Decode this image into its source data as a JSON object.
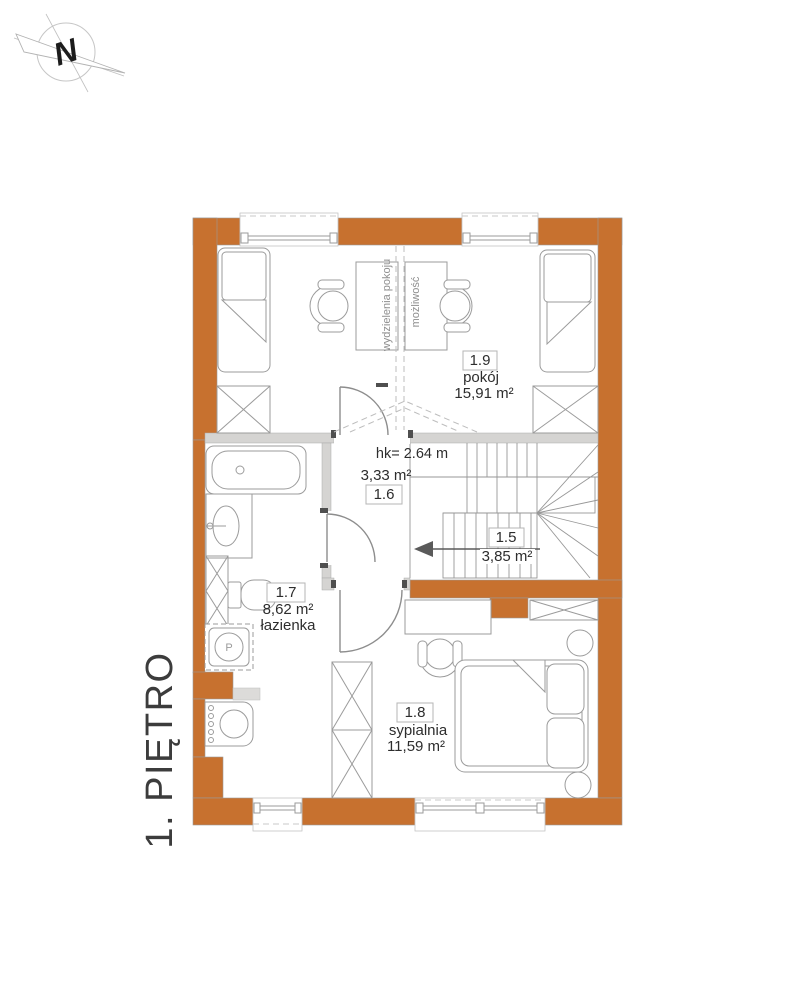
{
  "floor_label": "1. PIĘTRO",
  "compass": {
    "north_letter": "N"
  },
  "rooms": {
    "pokoj": {
      "number": "1.9",
      "name": "pokój",
      "area": "15,91 m²"
    },
    "hall": {
      "number": "1.6",
      "area": "3,33 m²",
      "height_note": "hk= 2.64 m"
    },
    "stairs": {
      "number": "1.5",
      "area": "3,85 m²"
    },
    "bathroom": {
      "number": "1.7",
      "name": "łazienka",
      "area": "8,62 m²"
    },
    "bedroom": {
      "number": "1.8",
      "name": "sypialnia",
      "area": "11,59 m²"
    }
  },
  "annotations": {
    "division_line_left": "wydzielenia pokoju",
    "division_line_right": "możliwość",
    "washer_symbol": "P"
  },
  "colors": {
    "wall_exterior": "#C7712F",
    "wall_interior": "#D5D4D2",
    "furniture_line": "#9B9B9B",
    "text": "#2D2D2D"
  }
}
